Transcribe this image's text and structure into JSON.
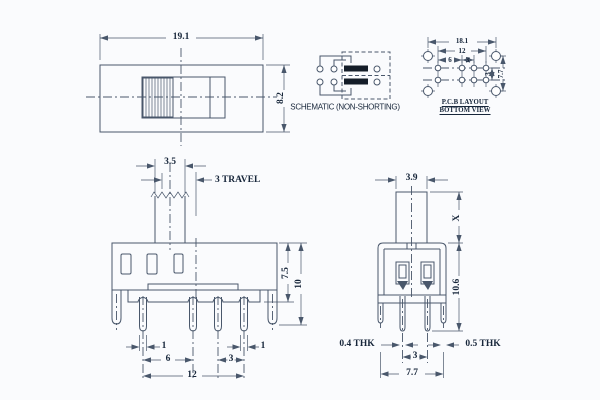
{
  "colors": {
    "line": "#49576b",
    "ink": "#17263a",
    "bg": "#fafbfd",
    "bar": "#141d28"
  },
  "top_view": {
    "width": "19.1",
    "height": "8.2"
  },
  "schematic": {
    "label": "SCHEMATIC (NON-SHORTING)"
  },
  "pcb": {
    "overall": "18.1",
    "span": "12",
    "pitch_a": "6",
    "pitch_b": "3",
    "row_gap": "3",
    "hole_span": "7.7",
    "caption1": "P.C.B LAYOUT",
    "caption2": "BOTTOM VIEW"
  },
  "front": {
    "knob_width": "3.5",
    "travel": "3  TRAVEL",
    "upper_height": "7.5",
    "total_height": "10",
    "pin_width_left": "1",
    "pitch_a": "6",
    "pitch_b": "3",
    "pin_width_right": "1",
    "span": "12"
  },
  "side": {
    "knob_width": "3.9",
    "knob_height": "X",
    "body_height": "10.6",
    "pin_thk": "0.4 THK",
    "leg_thk": "0.5 THK",
    "pin_pitch": "3",
    "leg_span": "7.7"
  }
}
